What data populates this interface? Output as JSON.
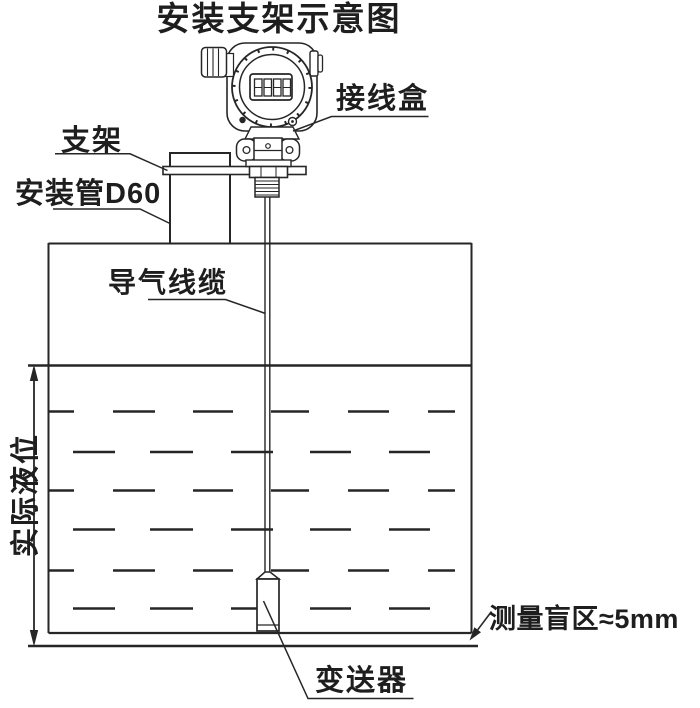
{
  "title": "安装支架示意图",
  "labels": {
    "junction_box": "接线盒",
    "bracket": "支架",
    "mounting_pipe": "安装管D60",
    "air_cable": "导气线缆",
    "actual_level": "实际液位",
    "blind_zone": "测量盲区≈5mm",
    "transmitter": "变送器"
  },
  "device": {
    "lcd_value": "8888"
  },
  "colors": {
    "line": "#262626",
    "text": "#1e1e1e",
    "background": "#ffffff"
  }
}
